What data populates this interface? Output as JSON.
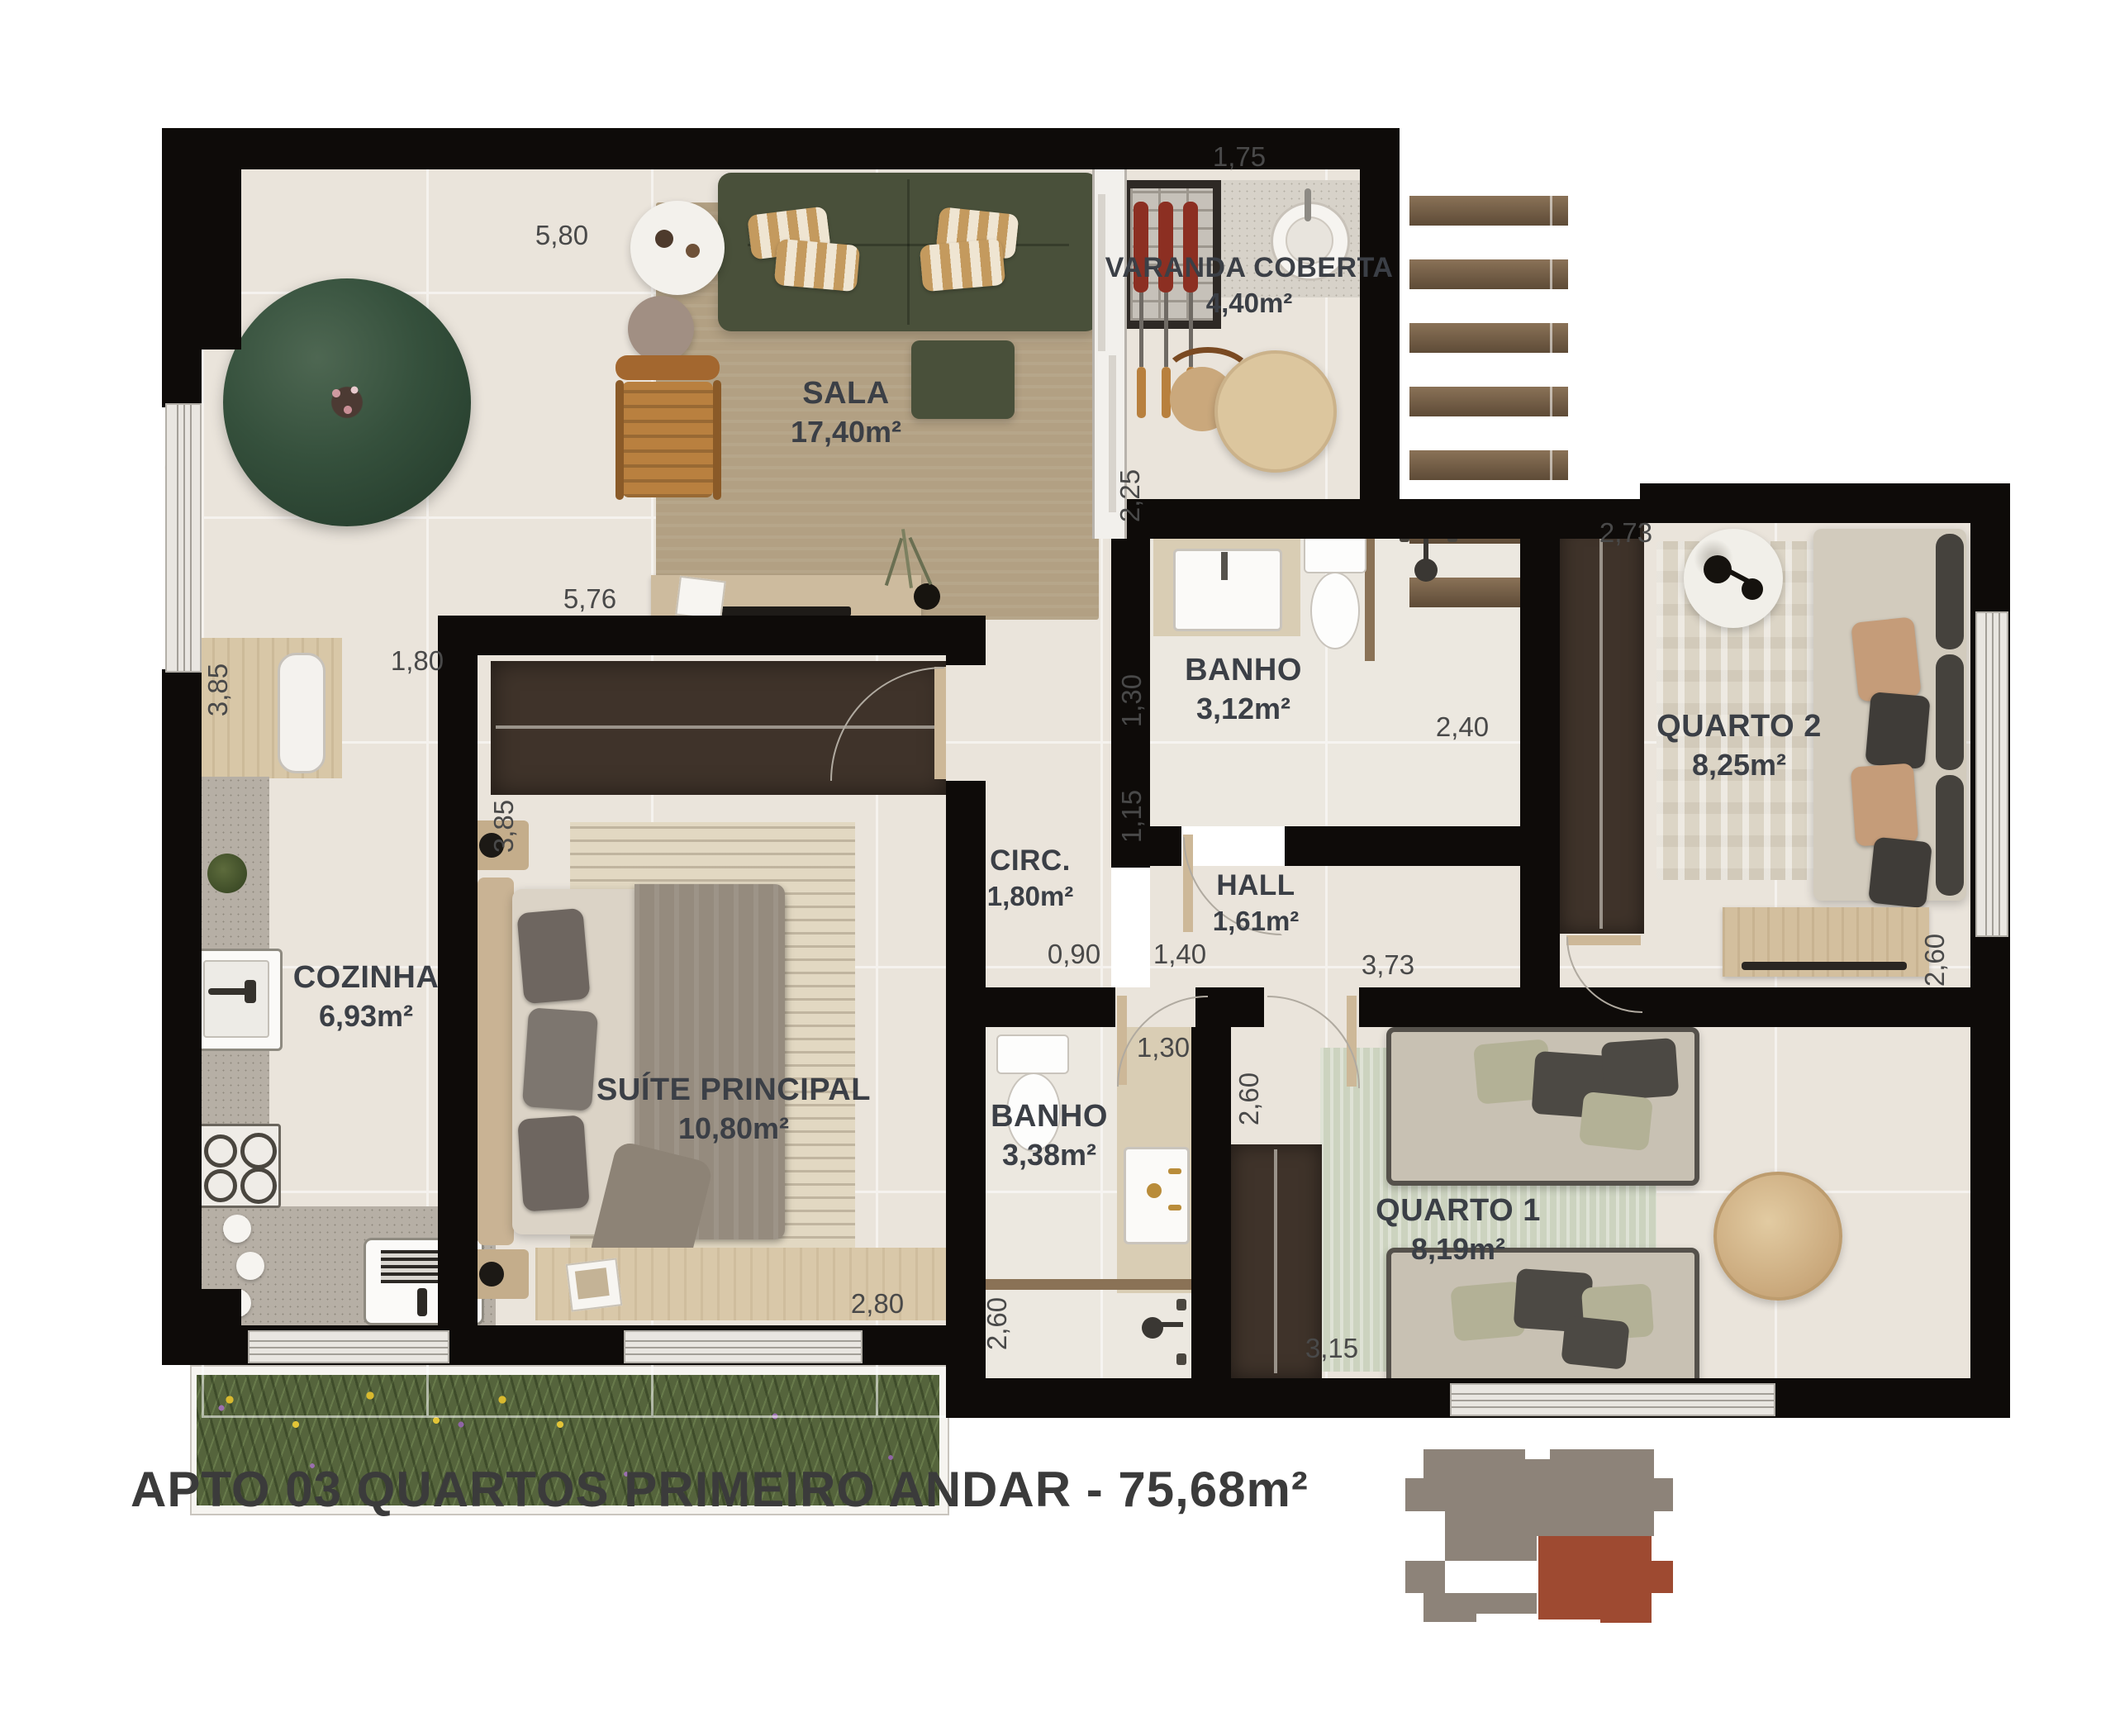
{
  "title": "APTO 03 QUARTOS PRIMEIRO ANDAR - 75,68m²",
  "rooms": [
    {
      "name": "SALA",
      "area": "17,40m²"
    },
    {
      "name": "VARANDA COBERTA",
      "area": "4,40m²"
    },
    {
      "name": "COZINHA",
      "area": "6,93m²"
    },
    {
      "name": "SUÍTE PRINCIPAL",
      "area": "10,80m²"
    },
    {
      "name": "CIRC.",
      "area": "1,80m²"
    },
    {
      "name": "BANHO",
      "area": "3,12m²"
    },
    {
      "name": "HALL",
      "area": "1,61m²"
    },
    {
      "name": "QUARTO 2",
      "area": "8,25m²"
    },
    {
      "name": "BANHO",
      "area": "3,38m²"
    },
    {
      "name": "QUARTO 1",
      "area": "8,19m²"
    }
  ],
  "dims": {
    "sala_top": "5,80",
    "varanda_top": "1,75",
    "varanda_right": "2,25",
    "suite_top": "5,76",
    "cozinha_passage": "1,80",
    "cozinha_left": "3,85",
    "suite_left": "3,85",
    "banho1_left": "1,30",
    "banho1_width": "2,40",
    "hall_left": "1,15",
    "quarto2_top": "2,73",
    "hall_seg1": "0,90",
    "hall_seg2": "1,40",
    "quarto1_top": "3,73",
    "banho2_top": "1,30",
    "quarto2_right": "2,60",
    "quarto1_left": "2,60",
    "banho2_left": "2,60",
    "suite_bottom": "2,80",
    "quarto1_bottom": "3,15"
  },
  "colors": {
    "wall": "#0e0b09",
    "floor": "#eae4db",
    "floor_bath": "#ece8e0",
    "sofa_green": "#49503a",
    "rug_tan": "#b2a083",
    "wood": "#a3672f",
    "granite": "#b6afa5",
    "closet_brown": "#3f332a",
    "planter_green": "#55643c",
    "stair_wood": "#7b6850",
    "key_gray": "#8d8379",
    "key_red": "#9e4a31",
    "label_text": "#3b3f46",
    "dim_text": "#494949"
  },
  "icons": {
    "bbq-grill-icon": "brick rectangle with three red skewers",
    "round-sink-icon": "circle basin",
    "toilet-icon": "tank + oval bowl",
    "shower-head-icon": "dot with stem",
    "stove-icon": "four burner circles",
    "fridge-icon": "white rounded rectangle",
    "stairs-icon": "seven wood treads",
    "planter-icon": "green strip with yellow and violet flowers",
    "building-key-icon": "gray footprint with red unit highlighted"
  }
}
